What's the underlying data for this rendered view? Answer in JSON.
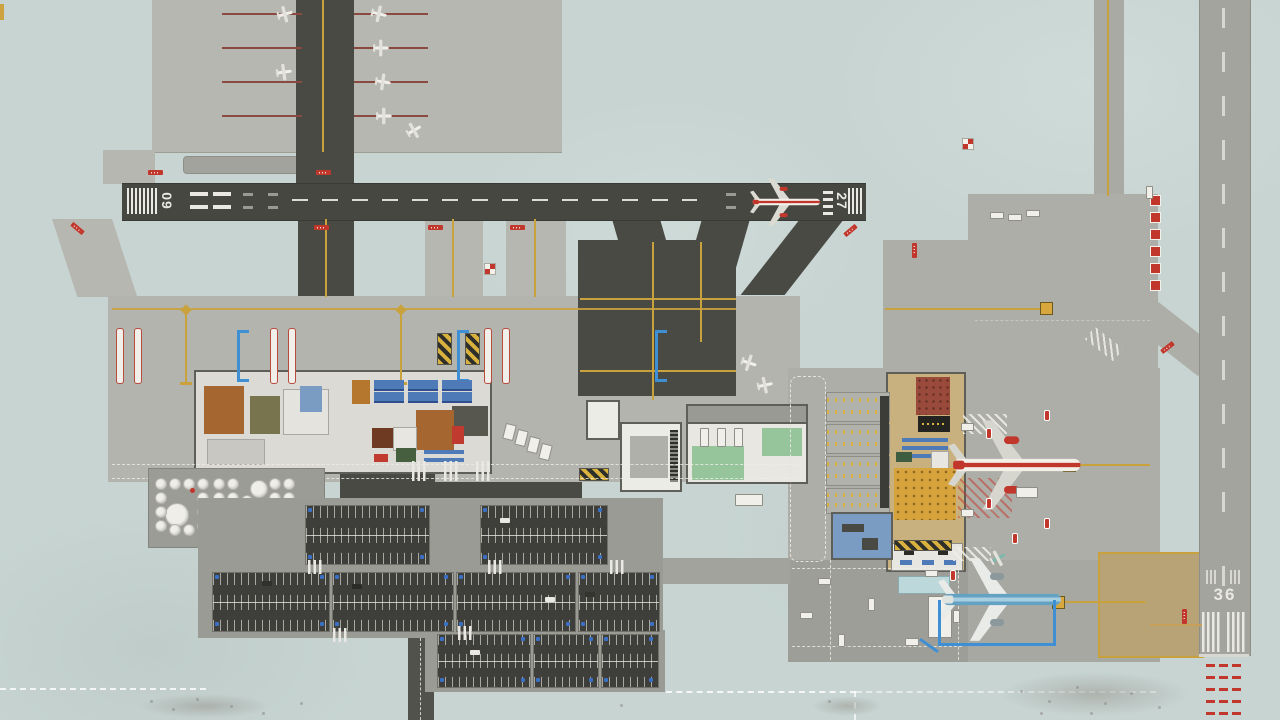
{
  "scene": {
    "title": "Airport overview",
    "description": "Top-down overhead view of an airport management game: two runways, general aviation apron, two terminals, fuel farm, car parks and service roads"
  },
  "runways": {
    "east_west": {
      "left_number": "09",
      "right_number": "27",
      "surface": "dark asphalt"
    },
    "north_south": {
      "number": "36",
      "surface": "light concrete"
    }
  },
  "aircraft": [
    {
      "name": "airliner-on-runway-27",
      "livery": "white with red stripe",
      "location": "runway 09/27 near threshold 27"
    },
    {
      "name": "widebody-at-terminal-2-stand",
      "livery": "white with red stripe and red engines",
      "location": "terminal 2 apron stand"
    },
    {
      "name": "airliner-at-remote-stand",
      "livery": "teal blue fuselage, white wings",
      "location": "south-east remote stand"
    },
    {
      "name": "ga-prop-plane-white",
      "count": 9,
      "livery": "white",
      "location": "general aviation apron and mid-field stands"
    },
    {
      "name": "ga-prop-plane-teal",
      "count": 1,
      "livery": "teal",
      "location": "near remote stand"
    }
  ],
  "facilities": [
    "general-aviation-apron",
    "terminal-1",
    "terminal-2",
    "baggage-building",
    "vehicle-depot",
    "fuel-farm",
    "car-parking-lots",
    "parking-garage",
    "remote-stands",
    "landside-roads",
    "hangar-strip"
  ],
  "markings": {
    "hold_short_signs": "red boards with white lettering at runway entries",
    "approach_lights": "red bars beyond runway 36 threshold",
    "boundary": "white dashed property line"
  },
  "palette": {
    "grass": "#c7d4d2",
    "apron": "#b4b4ae",
    "taxiway_asphalt": "#4a4a45",
    "runway_asphalt": "#474742",
    "runway_concrete": "#a4a49e",
    "taxi_line_yellow": "#c9a23d",
    "marking_white": "#e9e8e2",
    "marking_red": "#c2372c",
    "parking_asphalt": "#3e3e3a",
    "handicap_blue": "#3a6fc4",
    "terminal_tan": "#c9b07f",
    "depot_green": "#96c49b",
    "stand_blue": "#3f8fd4"
  }
}
